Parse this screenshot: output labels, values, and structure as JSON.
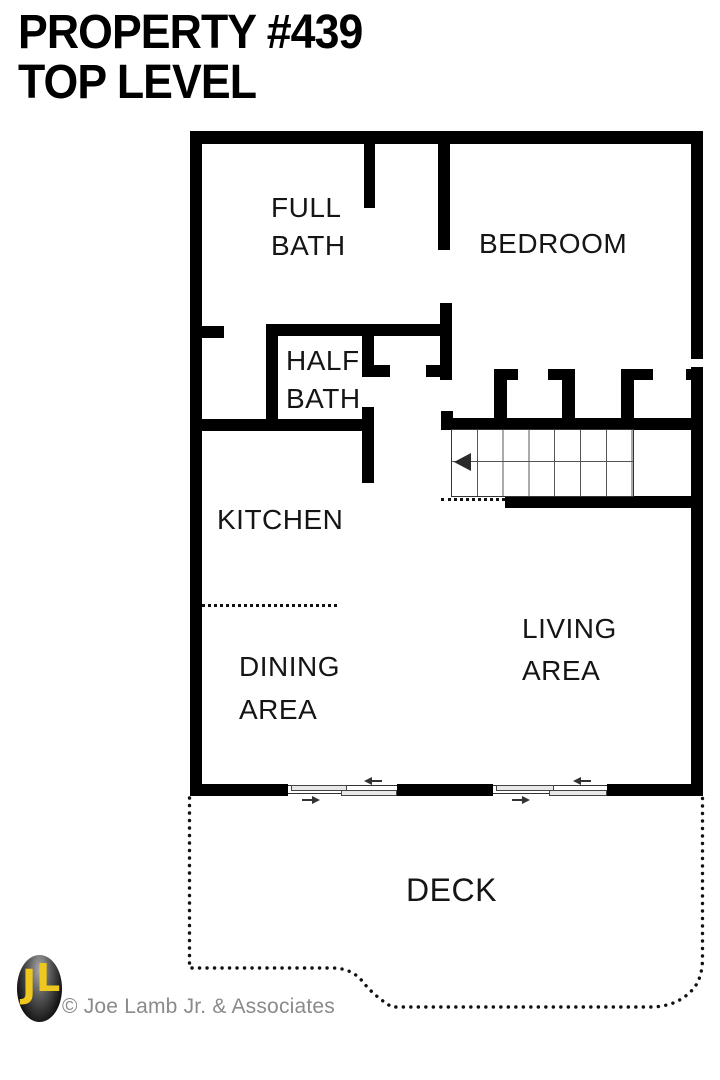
{
  "title": {
    "line1": "PROPERTY #439",
    "line2": "TOP LEVEL"
  },
  "rooms": {
    "full_bath": {
      "l1": "FULL",
      "l2": "BATH"
    },
    "bedroom": {
      "l1": "BEDROOM"
    },
    "half_bath": {
      "l1": "HALF",
      "l2": "BATH"
    },
    "kitchen": {
      "l1": "KITCHEN"
    },
    "dining": {
      "l1": "DINING",
      "l2": "AREA"
    },
    "living": {
      "l1": "LIVING",
      "l2": "AREA"
    },
    "deck": {
      "l1": "DECK"
    }
  },
  "stairs": {
    "direction_arrow": "left"
  },
  "footer": {
    "logo_initials": "JL",
    "copyright": "© Joe Lamb Jr. & Associates"
  },
  "colors": {
    "wall": "#000000",
    "label_text": "#151515",
    "copyright_gray": "#8a8a8a",
    "logo_yellow": "#eec81e",
    "background": "#ffffff"
  }
}
